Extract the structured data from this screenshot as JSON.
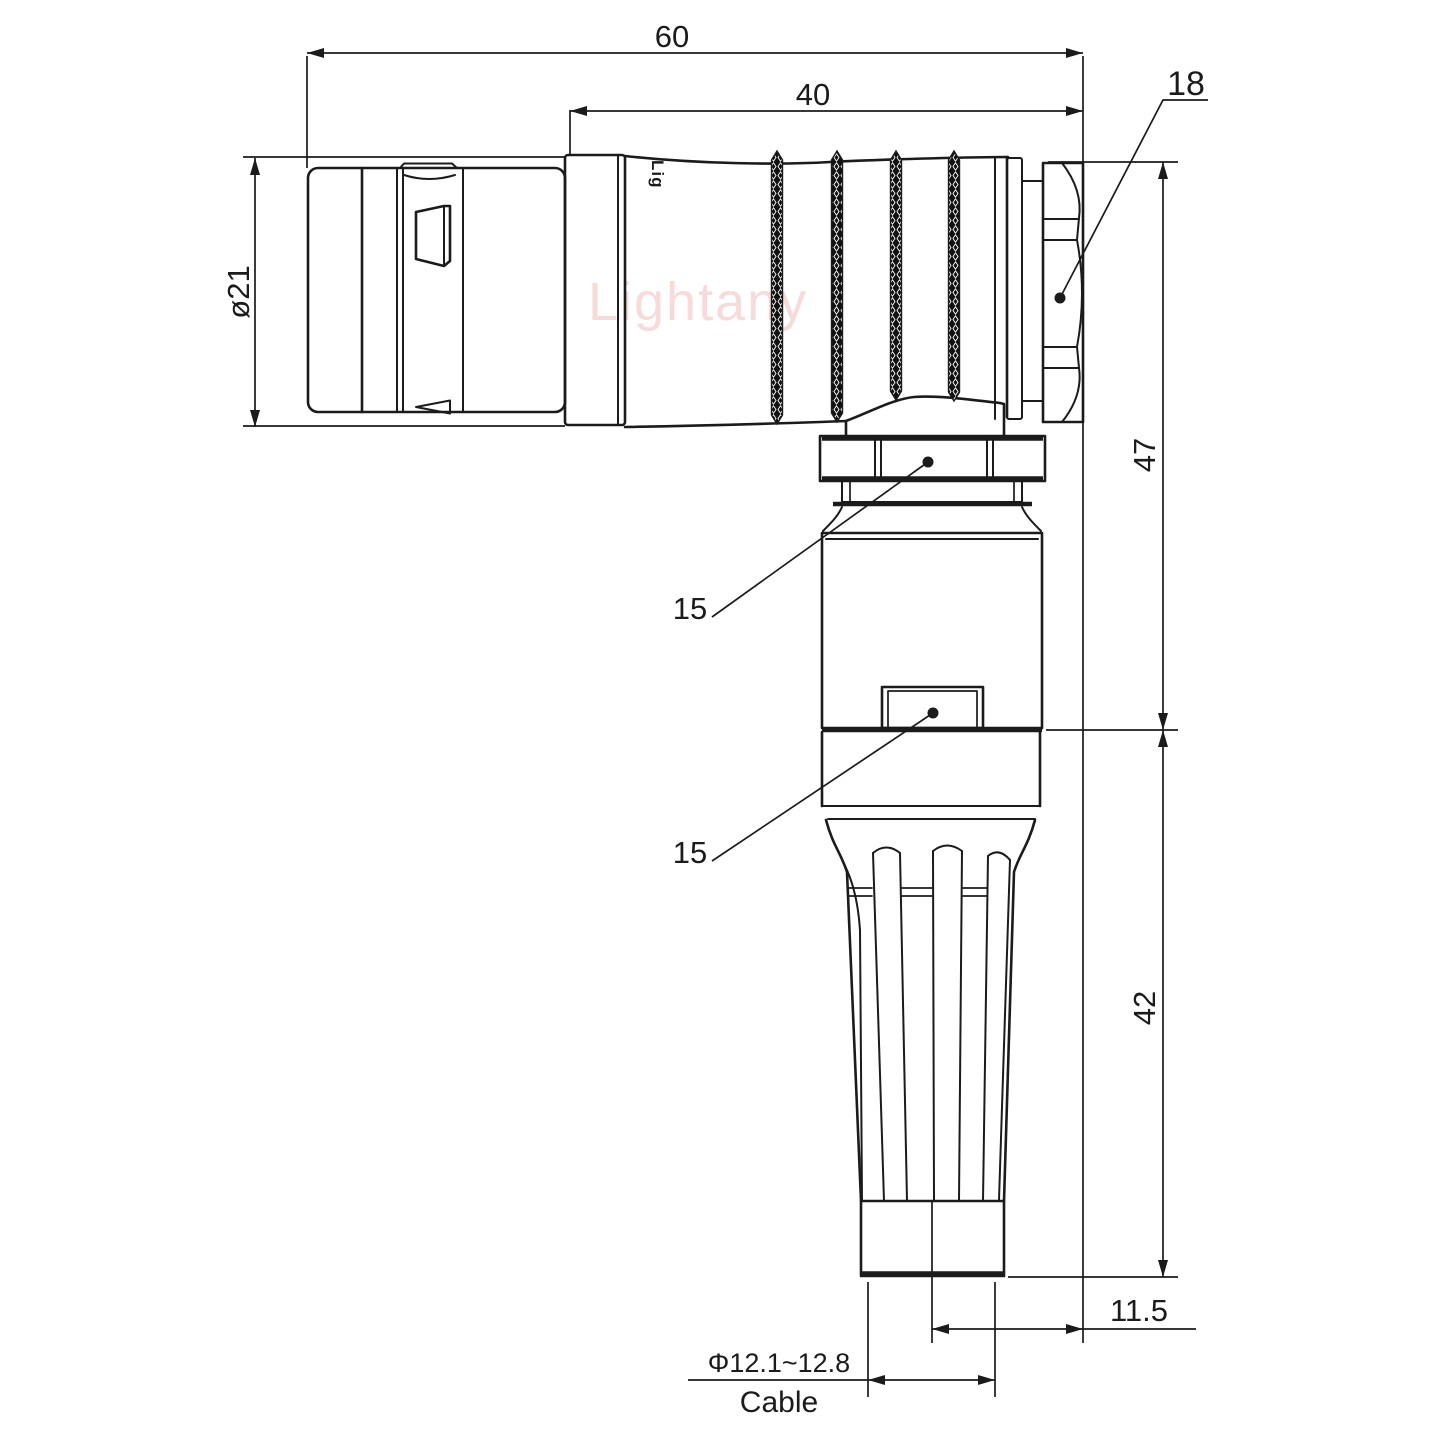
{
  "drawing": {
    "watermark": "Lightany",
    "part_marking": "Lig",
    "labels": {
      "dim_total_length": "60",
      "dim_barrel_length": "40",
      "dim_nut_across_flats": "18",
      "dim_front_diameter": "ø21",
      "dim_height_upper": "47",
      "dim_height_lower": "42",
      "dim_cable_offset": "11.5",
      "dim_cable_diameter_range": "Φ12.1~12.8",
      "cable_label": "Cable",
      "dim_coupling_nut_af": "15",
      "dim_backshell_af": "15"
    },
    "colors": {
      "line": "#1b1b1b",
      "watermark": "#f1bcbc",
      "background": "#ffffff"
    }
  }
}
